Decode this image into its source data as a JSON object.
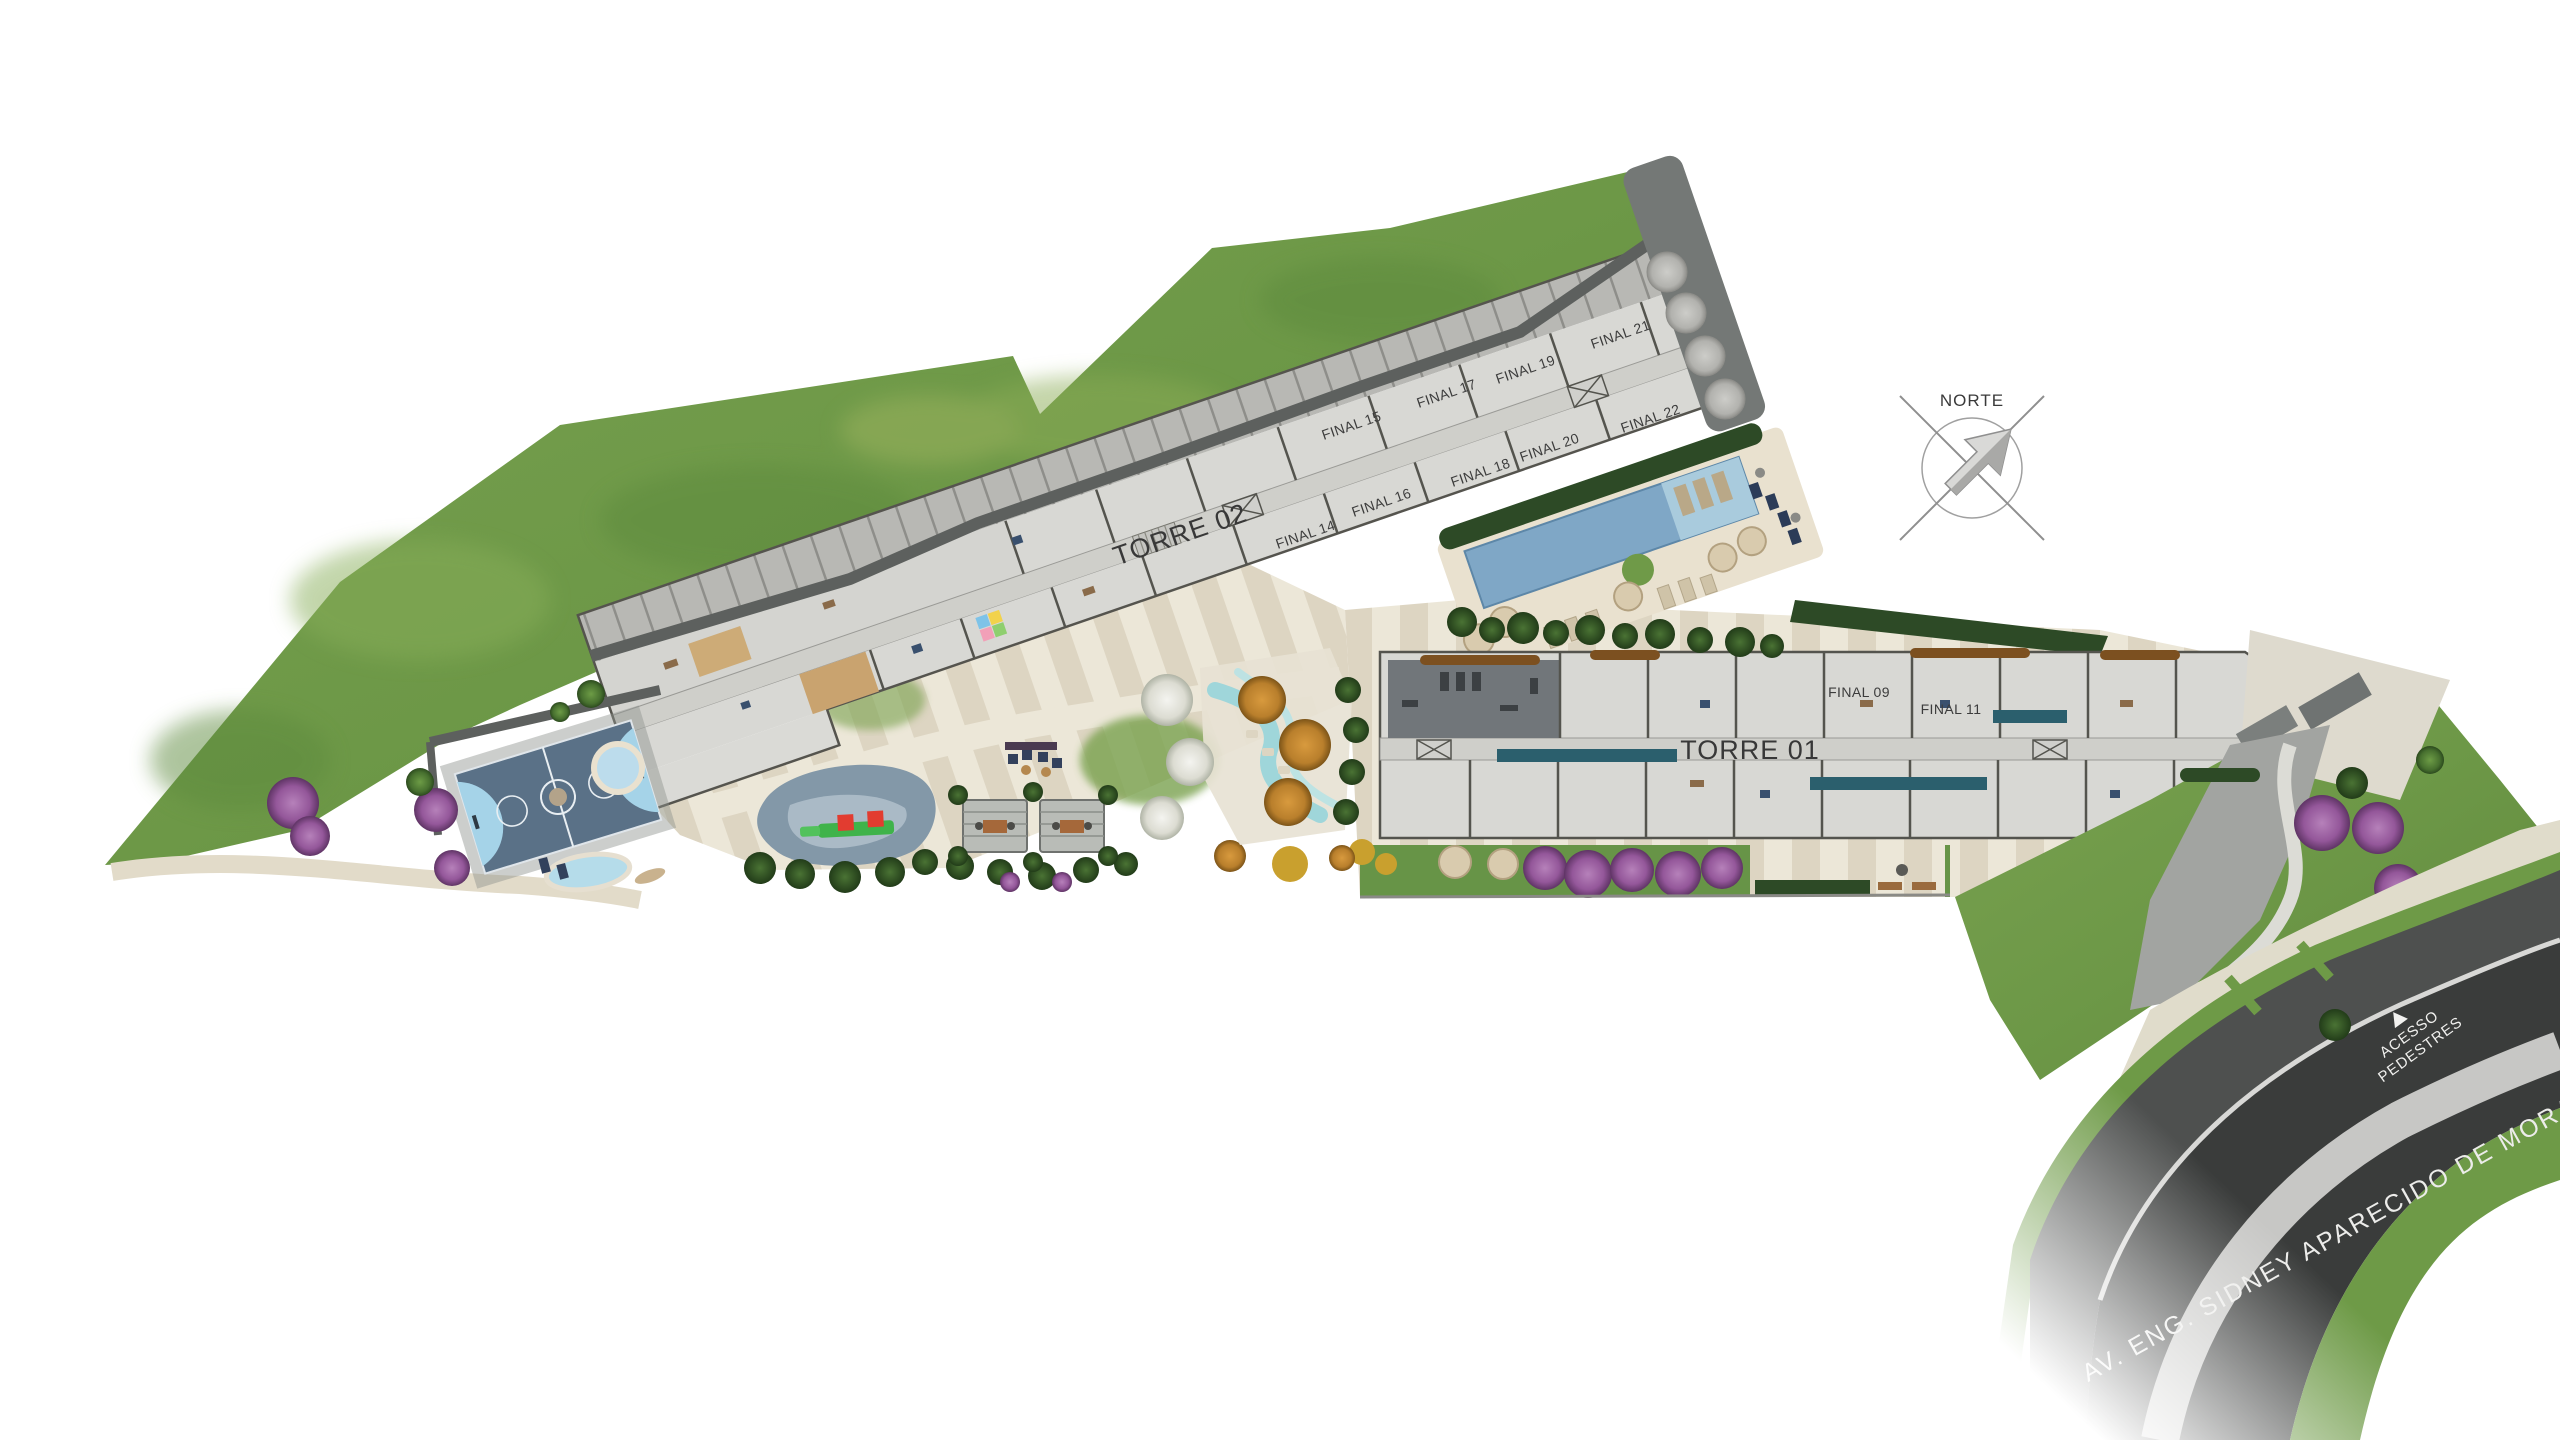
{
  "site": {
    "title_context": "residential development implantation plan",
    "towers": {
      "torre02": {
        "label": "TORRE 02",
        "units_top": [
          {
            "label": "FINAL 15"
          },
          {
            "label": "FINAL 17"
          },
          {
            "label": "FINAL 19"
          },
          {
            "label": "FINAL 21"
          }
        ],
        "units_bottom": [
          {
            "label": "FINAL 14"
          },
          {
            "label": "FINAL 16"
          },
          {
            "label": "FINAL 18"
          },
          {
            "label": "FINAL 20"
          },
          {
            "label": "FINAL 22"
          }
        ]
      },
      "torre01": {
        "label": "TORRE 01",
        "units": [
          {
            "label": "FINAL 09"
          },
          {
            "label": "FINAL 11"
          }
        ]
      }
    },
    "compass": {
      "label": "NORTE",
      "icon": "north-arrow-icon"
    },
    "pedestrian_access": {
      "line1": "ACESSO",
      "line2": "PEDESTRES",
      "icon": "access-triangle-icon"
    },
    "street": {
      "name": "AV. ENG. SIDNEY APARECIDO DE MORAES"
    },
    "colors": {
      "lawn_green": "#6f9a48",
      "building_gray": "#d8d8d4",
      "garage_gray": "#b8b8b4",
      "wall_gray": "#5d605e",
      "pool_blue": "#7fa7c6",
      "pool_shallow_blue": "#a9cbdd",
      "lap_pool_teal": "#2b5f6d",
      "deck_beige": "#e9e1cf",
      "plaza_beige": "#ddd5c2",
      "road_asphalt": "#3a3c3b",
      "road_median": "#c7c7c5",
      "sidewalk_gray": "#4e504f",
      "court_blue": "#5a7187",
      "court_light_blue": "#a5d3e8",
      "playground_surface": "#8398a8",
      "purple_tree": "#9a5d9e",
      "orange_tree": "#c8862e",
      "label_dark": "#3a3a3a"
    }
  }
}
